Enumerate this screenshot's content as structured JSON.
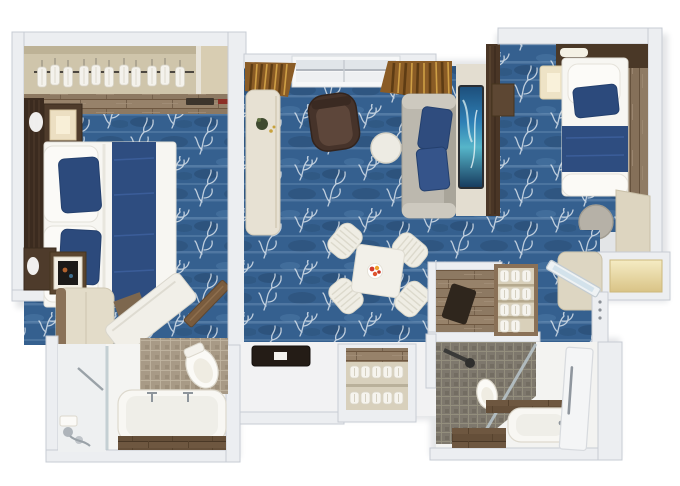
{
  "figure": {
    "type": "3d-floor-plan",
    "description": "Top-down 3D rendered floor plan of a two-bedroom suite with living-dining area and two bathrooms",
    "rooms": {
      "master_bedroom": {
        "label": "Master bedroom",
        "furniture": [
          "wardrobe-closet-with-hangers",
          "king-bed-white-duvet-navy-runner",
          "navy-accent-pillows",
          "dark-wood-headboard",
          "nightstand-with-lamp",
          "wall-sconce",
          "tv-console",
          "cream-wardrobe",
          "tilted-lounger-desk",
          "wood-entry-door"
        ]
      },
      "living_dining": {
        "label": "Living and dining room",
        "furniture": [
          "balcony-sliding-door",
          "curtains",
          "writing-desk",
          "brown-armchair",
          "round-side-table",
          "gray-sofa-navy-pillows",
          "wall-tv",
          "dining-table-with-flowers",
          "dining-chairs-x4",
          "dark-console-table"
        ]
      },
      "entry_hall": {
        "label": "Entry hall",
        "furniture": [
          "shoe-and-slipper-shelf"
        ]
      },
      "master_bathroom": {
        "label": "Master bathroom",
        "furniture": [
          "walk-in-shower",
          "glass-partition",
          "toilet",
          "bathtub",
          "wood-shelf",
          "chrome-fixtures"
        ]
      },
      "second_bedroom": {
        "label": "Second bedroom",
        "furniture": [
          "single-bed-navy-runner",
          "bedside-lamp",
          "headboard-panel",
          "wall-cabinet",
          "round-table",
          "vanity-desk",
          "luggage-niche"
        ]
      },
      "second_entry": {
        "label": "Second suite entry",
        "furniture": [
          "storage-shelf-unit",
          "luggage",
          "open-glass-door",
          "lit-wall-niche",
          "cream-cabinet"
        ]
      },
      "second_bathroom": {
        "label": "Second bathroom",
        "furniture": [
          "mosaic-shower",
          "shower-arm",
          "toilet",
          "wood-bench",
          "vanity-sink",
          "white-door"
        ]
      }
    }
  },
  "palette": {
    "wall": "#eceef1",
    "wall_edge": "#c7ccd4",
    "wall_dark": "#dfe2e6",
    "carpet": "#35608f",
    "carpet_dark": "#27496f",
    "carpet_light": "#7fa2c6",
    "branch_white": "#e6edf4",
    "wood": "#97826a",
    "wood_dark": "#6e5740",
    "dark_wood_wall": "#4a3626",
    "headboard": "#3b2b1f",
    "closet_interior": "#cfc5ab",
    "cream": "#e7e1d3",
    "bedding_white": "#f7f6f2",
    "bedding_navy": "#2e4d80",
    "pillow_navy": "#2c4a7c",
    "sofa_gray": "#bcb8ae",
    "armchair_brown": "#46332a",
    "curtain_bronze": "#8a5c26",
    "tv_screen_blue": "#2e7fb5",
    "flower_red": "#d23b2f",
    "flower_orange": "#f0a22d",
    "tile_beige": "#a89a86",
    "tile_gray": "#7e786d",
    "fixture_white": "#f8f7f3",
    "chrome": "#9aa2a8"
  }
}
